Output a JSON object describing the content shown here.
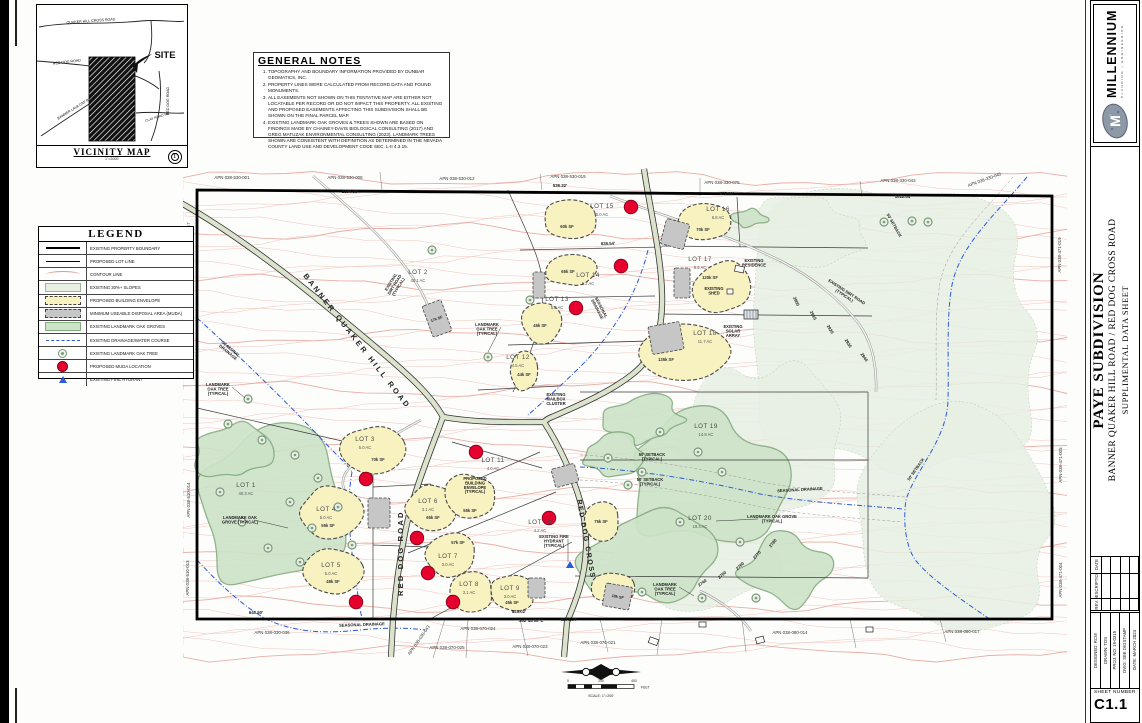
{
  "sheet": {
    "vicinity": {
      "title": "VICINITY MAP",
      "scale": "1\"=2000'",
      "labels": [
        {
          "t": "QUAKER HILL CROSS ROAD",
          "x": 90,
          "y": 21,
          "r": -4,
          "s": 3.6
        },
        {
          "t": "RED DOG ROAD",
          "x": 66,
          "y": 62,
          "r": -7,
          "s": 3.6
        },
        {
          "t": "BANNER LAVA CAP ROAD",
          "x": 76,
          "y": 107,
          "r": -32,
          "s": 3.6
        },
        {
          "t": "RED DOG ROAD",
          "x": 168,
          "y": 100,
          "r": -90,
          "s": 3.6
        },
        {
          "t": "CLAY ROAD RD.",
          "x": 157,
          "y": 117,
          "r": -18,
          "s": 3.4
        },
        {
          "t": "SITE",
          "x": 164,
          "y": 57,
          "r": 0,
          "s": 9.5,
          "w": "bold"
        }
      ]
    },
    "general_notes": {
      "title": "GENERAL NOTES",
      "notes": [
        "TOPOGRAPHY AND BOUNDARY INFORMATION PROVIDED BY DUNBAR GEOMATICS, INC.",
        "PROPERTY LINES WERE CALCULATED FROM RECORD DATA AND FOUND MONUMENTS.",
        "ALL EASEMENTS NOT SHOWN ON THIS TENTATIVE MAP ARE EITHER NOT LOCATABLE PER RECORD OR DO NOT IMPACT THIS PROPERTY.  ALL EXISTING AND PROPOSED EASEMENTS AFFECTING THIS SUBDIVISION SHALL BE SHOWN ON THE FINAL PARCEL MAP.",
        "EXISTING LANDMARK OAK GROVES & TREES SHOWN ARE BASED ON FINDINGS MADE BY CHAINEY-DAVIS BIOLOGICAL CONSULTING (2017) AND GREG MATUZAK ENVIRONMENTAL CONSULTING (2023). LANDMARK TREES SHOWN ARE CONSISTENT WITH DEFINITION AS DETERMINED IN THE NEVADA COUNTY LAND USE AND DEVELOPMENT CODE SEC. L-II 4.3.15."
      ]
    },
    "legend": {
      "title": "LEGEND",
      "items": [
        {
          "symbol": "boundary",
          "label": "EXISTING PROPERTY BOUNDARY"
        },
        {
          "symbol": "lotline",
          "label": "PROPOSED LOT LINE"
        },
        {
          "symbol": "contour",
          "label": "CONTOUR LINE"
        },
        {
          "symbol": "slopes",
          "label": "EXISTING 30%+ SLOPES"
        },
        {
          "symbol": "envelope",
          "label": "PROPOSED BUILDING ENVELOPE"
        },
        {
          "symbol": "muda",
          "label": "MINIMUM USEABLE DISPOSAL AREA (MUDA)"
        },
        {
          "symbol": "grove",
          "label": "EXISTING LANDMARK OAK GROVES"
        },
        {
          "symbol": "drain",
          "label": "EXISTING DRAINAGE/WATER COURSE"
        },
        {
          "symbol": "tree",
          "label": "EXISTING LANDMARK OAK TREE"
        },
        {
          "symbol": "dot",
          "label": "PROPOSED MUDA LOCATION"
        },
        {
          "symbol": "hydrant",
          "label": "EXISTING FIRE HYDRANT"
        }
      ]
    },
    "map": {
      "lots": [
        {
          "n": "LOT 1",
          "a": "40.3 AC",
          "x": 246,
          "y": 487
        },
        {
          "n": "LOT 2",
          "a": "40.1 AC",
          "x": 418,
          "y": 274
        },
        {
          "n": "LOT 3",
          "a": "5.0 AC",
          "x": 365,
          "y": 441,
          "env": [
            372,
            449,
            34,
            25
          ],
          "sf": "70k SF",
          "sx": 378,
          "sy": 461
        },
        {
          "n": "LOT 4",
          "a": "5.0 AC",
          "x": 326,
          "y": 511,
          "env": [
            331,
            512,
            33,
            27
          ],
          "sf": "55k SF",
          "sx": 328,
          "sy": 527
        },
        {
          "n": "LOT 5",
          "a": "5.0 AC",
          "x": 331,
          "y": 567,
          "env": [
            333,
            572,
            31,
            25
          ],
          "sf": "48k SF",
          "sx": 333,
          "sy": 583
        },
        {
          "n": "LOT 6",
          "a": "3.1 AC",
          "x": 428,
          "y": 503,
          "env": [
            433,
            508,
            29,
            26
          ],
          "sf": "65k SF",
          "sx": 433,
          "sy": 519
        },
        {
          "n": "LOT 7",
          "a": "3.0 AC",
          "x": 448,
          "y": 558,
          "env": [
            452,
            556,
            27,
            24
          ],
          "sf": "57k SF",
          "sx": 458,
          "sy": 544
        },
        {
          "n": "LOT 8",
          "a": "3.1 AC",
          "x": 469,
          "y": 586,
          "env": [
            470,
            591,
            25,
            21
          ]
        },
        {
          "n": "LOT 9",
          "a": "3.0 AC",
          "x": 510,
          "y": 590,
          "env": [
            512,
            593,
            25,
            20
          ],
          "sf": "45k SF",
          "sx": 512,
          "sy": 604
        },
        {
          "n": "LOT 10",
          "a": "4.2 AC",
          "x": 540,
          "y": 524,
          "env": [
            601,
            521,
            20,
            23
          ],
          "sf": "75k SF",
          "sx": 601,
          "sy": 523
        },
        {
          "n": "LOT 11",
          "a": "4.0 AC",
          "x": 493,
          "y": 462,
          "env": [
            470,
            497,
            29,
            24
          ],
          "sf": "55k SF",
          "sx": 470,
          "sy": 512
        },
        {
          "n": "LOT 12",
          "a": "4.5 AC",
          "x": 518,
          "y": 359,
          "env": [
            524,
            372,
            16,
            21
          ],
          "sf": "44k SF",
          "sx": 524,
          "sy": 376
        },
        {
          "n": "LOT 13",
          "a": "5.0 AC",
          "x": 557,
          "y": 301,
          "env": [
            542,
            323,
            23,
            21
          ],
          "sf": "46k SF",
          "sx": 540,
          "sy": 327
        },
        {
          "n": "LOT 14",
          "a": "5.2 AC",
          "x": 588,
          "y": 277,
          "env": [
            572,
            270,
            29,
            17
          ],
          "sf": "65k SF",
          "sx": 568,
          "sy": 273
        },
        {
          "n": "LOT 15",
          "a": "5.0 AC",
          "x": 602,
          "y": 208,
          "env": [
            571,
            219,
            28,
            22
          ],
          "sf": "60k SF",
          "sx": 567,
          "sy": 228
        },
        {
          "n": "LOT 16",
          "a": "6.8 AC",
          "x": 718,
          "y": 211,
          "env": [
            705,
            221,
            29,
            21
          ],
          "sf": "70k SF",
          "sx": 703,
          "sy": 231
        },
        {
          "n": "LOT 17",
          "a": "8.5 AC",
          "x": 700,
          "y": 261,
          "env": [
            722,
            287,
            32,
            28
          ],
          "sf": "120k SF",
          "sx": 710,
          "sy": 279
        },
        {
          "n": "LOT 18",
          "a": "11.7 AC",
          "x": 705,
          "y": 335,
          "env": [
            686,
            352,
            50,
            28
          ],
          "sf": "135k SF",
          "sx": 666,
          "sy": 361
        },
        {
          "n": "LOT 19",
          "a": "14.9 AC",
          "x": 706,
          "y": 428
        },
        {
          "n": "LOT 20",
          "a": "19.4 AC",
          "x": 700,
          "y": 520
        }
      ],
      "extra_envelopes": [
        [
          613,
          588,
          22,
          17
        ]
      ],
      "muda": [
        [
          663,
          221,
          24,
          26,
          15,
          ""
        ],
        [
          674,
          268,
          16,
          30,
          0,
          ""
        ],
        [
          650,
          324,
          32,
          28,
          -10,
          ""
        ],
        [
          553,
          466,
          24,
          19,
          -15,
          ""
        ],
        [
          427,
          302,
          20,
          33,
          -20,
          "17k SF"
        ],
        [
          368,
          498,
          22,
          30,
          0,
          ""
        ],
        [
          528,
          578,
          17,
          20,
          0,
          ""
        ],
        [
          604,
          585,
          27,
          23,
          10,
          "18k SF"
        ],
        [
          533,
          272,
          12,
          26,
          0,
          ""
        ]
      ],
      "muda_dots": [
        [
          631,
          207
        ],
        [
          621,
          266
        ],
        [
          576,
          308
        ],
        [
          476,
          452
        ],
        [
          549,
          518
        ],
        [
          417,
          538
        ],
        [
          428,
          573
        ],
        [
          366,
          479
        ],
        [
          356,
          602
        ],
        [
          453,
          602
        ]
      ],
      "hydrants": [
        [
          570,
          565
        ]
      ],
      "apns": [
        [
          "APN 038-530-001",
          232,
          179,
          0
        ],
        [
          "APN 038-530-008",
          345,
          179,
          0
        ],
        [
          "APN 038-530-012",
          457,
          180,
          0
        ],
        [
          "APN 038-530-019",
          568,
          178,
          0
        ],
        [
          "APN 038-330-075",
          722,
          184,
          0
        ],
        [
          "APN 038-330-043",
          898,
          182,
          0
        ],
        [
          "APN 038-330-045",
          985,
          181,
          -20
        ],
        [
          "APN 038-471-019",
          1061,
          255,
          -90
        ],
        [
          "APN 038-471-005",
          1062,
          465,
          -90
        ],
        [
          "APN 038-471-004",
          1062,
          580,
          -90
        ],
        [
          "APN 038-530-017",
          190,
          240,
          -90
        ],
        [
          "APN 038-510-012",
          190,
          335,
          -90
        ],
        [
          "APN 038-510-014",
          190,
          500,
          -90
        ],
        [
          "APN 038-510-013",
          189,
          578,
          -90
        ],
        [
          "APN 038-030-036",
          272,
          634,
          0
        ],
        [
          "APN 038-030-043",
          420,
          641,
          -55
        ],
        [
          "APN 038-070-025",
          447,
          649,
          0
        ],
        [
          "APN 038-070-024",
          478,
          630,
          0
        ],
        [
          "APN 038-070-023",
          530,
          648,
          0
        ],
        [
          "APN 038-070-021",
          598,
          644,
          0
        ],
        [
          "APN 038-080-014",
          790,
          634,
          0
        ],
        [
          "APN 038-080-017",
          962,
          633,
          0
        ]
      ],
      "road_labels": [
        {
          "t": "BANNER QUAKER HILL ROAD",
          "x": 303,
          "y": 276,
          "r": 52,
          "s": 7.5,
          "ls": 2.6
        },
        {
          "t": "RED DOG ROAD",
          "x": 403,
          "y": 596,
          "r": -90,
          "s": 7.5,
          "ls": 2.2
        },
        {
          "t": "RED DOG CROSS",
          "x": 577,
          "y": 500,
          "r": 80,
          "s": 7,
          "ls": 1.6
        }
      ],
      "annotations": [
        {
          "t": "LANDMARK\nOAK TREE\n(TYPICAL)",
          "x": 218,
          "y": 386,
          "lead": [
            245,
            398
          ]
        },
        {
          "t": "LANDMARK\nOAK TREE\n(TYPICAL)",
          "x": 487,
          "y": 326,
          "lead": [
            488,
            352
          ]
        },
        {
          "t": "LANDMARK OAK\nGROVE (TYPICAL)",
          "x": 240,
          "y": 519,
          "lead": [
            288,
            528
          ]
        },
        {
          "t": "LANDMARK OAK GROVE\n(TYPICAL)",
          "x": 772,
          "y": 518,
          "lead": [
            716,
            521
          ]
        },
        {
          "t": "LANDMARK\nOAK TREE\n(TYPICAL)",
          "x": 665,
          "y": 586,
          "lead": [
            694,
            596
          ]
        },
        {
          "t": "EXISTING\nDIRT ROAD\n(TYPICAL)",
          "x": 392,
          "y": 283,
          "r": -58
        },
        {
          "t": "EXISTING DIRT ROAD\n(TYPICAL)",
          "x": 846,
          "y": 293,
          "r": 33
        },
        {
          "t": "EXISTING FIRE\nHYDRANT\n(TYPICAL)",
          "x": 554,
          "y": 538,
          "lead": [
            568,
            562
          ]
        },
        {
          "t": "PROPOSED\nBUILDING\nENVELOPE\n(TYPICAL)",
          "x": 475,
          "y": 480
        },
        {
          "t": "EXISTING\nRESIDENCE",
          "x": 754,
          "y": 262
        },
        {
          "t": "EXISTING\nSHED",
          "x": 714,
          "y": 290
        },
        {
          "t": "EXISTING\nSOLAR\nARRAY",
          "x": 733,
          "y": 328
        },
        {
          "t": "EXISTING\nMAILBOX\nCLUSTER",
          "x": 556,
          "y": 396
        },
        {
          "t": "SEASONAL\nDRAINAGE",
          "x": 230,
          "y": 350,
          "r": 40
        },
        {
          "t": "SEASONAL\nDRAINAGE",
          "x": 600,
          "y": 308,
          "r": 62
        },
        {
          "t": "SEASONAL DRAINAGE",
          "x": 800,
          "y": 491,
          "r": -3
        },
        {
          "t": "SEASONAL DRAINAGE",
          "x": 362,
          "y": 626,
          "r": -2
        },
        {
          "t": "50' SETBACK\n(TYPICAL)",
          "x": 652,
          "y": 456
        },
        {
          "t": "50' SETBACK\n(TYPICAL)",
          "x": 650,
          "y": 481
        },
        {
          "t": "50' SETBACK",
          "x": 893,
          "y": 226,
          "r": 60
        },
        {
          "t": "50' SETBACK",
          "x": 917,
          "y": 470,
          "r": -55
        }
      ],
      "dimensions": [
        [
          "2150.55'",
          350,
          193,
          0
        ],
        [
          "536.32'",
          560,
          187,
          0
        ],
        [
          "875.81'",
          727,
          195,
          0
        ],
        [
          "1012.04'",
          903,
          198,
          0
        ],
        [
          "838.54'",
          608,
          245,
          -2
        ],
        [
          "640.50'",
          256,
          614,
          0
        ],
        [
          "823.02'",
          519,
          613,
          0
        ],
        [
          "S62°48'08\"E",
          531,
          622,
          0
        ],
        [
          "5273.34'",
          569,
          621,
          0
        ],
        [
          "3615.86'",
          193,
          358,
          -90
        ],
        [
          "2900",
          795,
          302,
          65
        ],
        [
          "2910",
          812,
          316,
          62
        ],
        [
          "2920",
          829,
          330,
          60
        ],
        [
          "2930",
          847,
          344,
          58
        ],
        [
          "2940",
          863,
          358,
          55
        ],
        [
          "2740",
          703,
          584,
          -35
        ],
        [
          "2750",
          723,
          576,
          -40
        ],
        [
          "2760",
          741,
          567,
          -44
        ],
        [
          "2770",
          758,
          556,
          -48
        ],
        [
          "2780",
          774,
          544,
          -52
        ]
      ],
      "margin_note": "7"
    },
    "scalebar": {
      "n0": "0",
      "n200": "200",
      "n400": "400",
      "unit": "FEET",
      "label": "SCALE: 1\"=200'"
    },
    "titleblock": {
      "firm": "MILLENNIUM",
      "firm_sub": "PLANNING | ENGINEERING",
      "project": "PAYE SUBDIVISION",
      "location": "BANNER QUAKER HILL ROAD / RED DOG CROSS ROAD",
      "sheet_title": "SUPPLIMENTAL DATA SHEET",
      "rev_headers": [
        "DATE",
        "DESCRIPTION",
        "REV."
      ],
      "info": [
        "DESIGNED: RCW",
        "DRAWN: TDS",
        "PROJ. NO: 19-0315",
        "DWG: SEE DIGSTAMP",
        "DATE: MARCH 2024"
      ],
      "sheet_number_label": "SHEET NUMBER",
      "sheet_number": "C1.1"
    }
  }
}
